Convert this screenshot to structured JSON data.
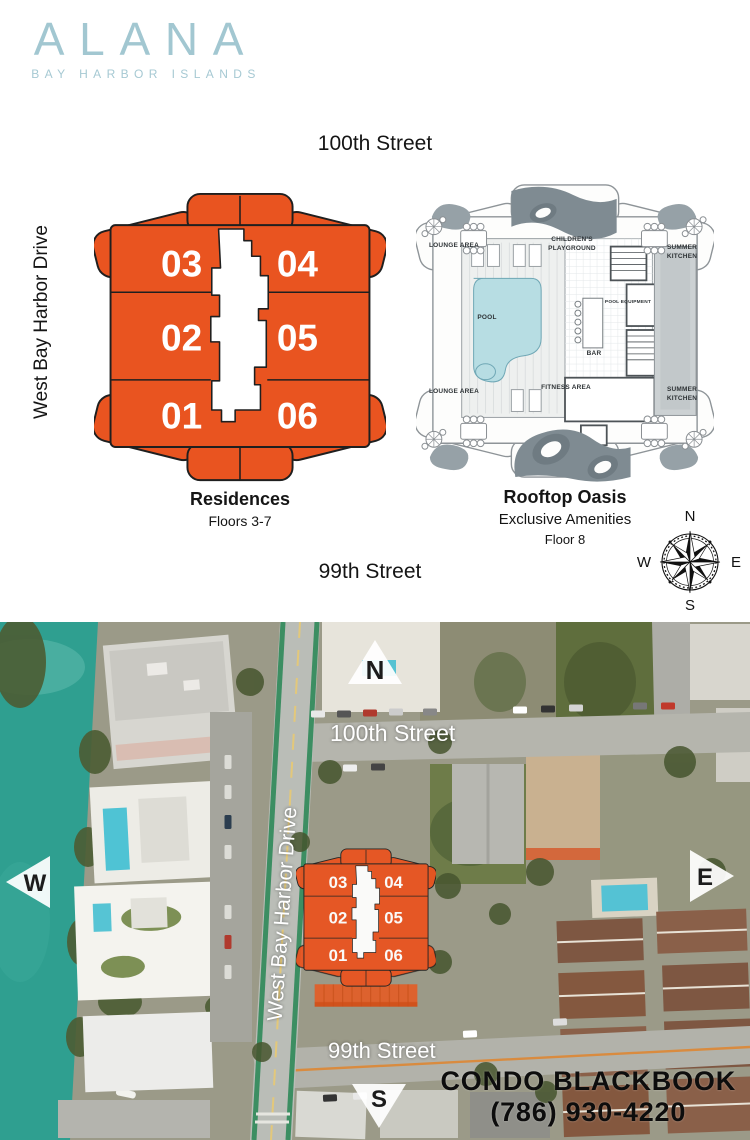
{
  "brand": {
    "name": "ALANA",
    "tagline": "BAY HARBOR ISLANDS"
  },
  "plans": {
    "street_top": "100th Street",
    "street_left": "West Bay Harbor Drive",
    "street_bottom": "99th Street",
    "residences": {
      "title": "Residences",
      "subtitle": "Floors 3-7",
      "units": [
        "01",
        "02",
        "03",
        "04",
        "05",
        "06"
      ]
    },
    "rooftop": {
      "title": "Rooftop Oasis",
      "subtitle": "Exclusive Amenities",
      "floor": "Floor 8",
      "labels": {
        "lounge_top": "LOUNGE AREA",
        "playground": "CHILDREN'S PLAYGROUND",
        "summer_top": "SUMMER KITCHEN",
        "pool": "POOL",
        "bar": "BAR",
        "pool_equipment": "POOL EQUIPMENT",
        "lounge_bottom": "LOUNGE AREA",
        "fitness": "FITNESS AREA",
        "summer_bottom": "SUMMER KITCHEN"
      }
    },
    "compass": {
      "n": "N",
      "e": "E",
      "s": "S",
      "w": "W"
    }
  },
  "map": {
    "street_100": "100th Street",
    "street_99": "99th Street",
    "street_wbhd": "West Bay Harbor Drive",
    "markers": {
      "n": "N",
      "e": "E",
      "s": "S",
      "w": "W"
    },
    "units": [
      "01",
      "02",
      "03",
      "04",
      "05",
      "06"
    ],
    "advertiser": {
      "name": "CONDO BLACKBOOK",
      "phone": "(786) 930-4220"
    }
  },
  "colors": {
    "brand_blue": "#A2C7D1",
    "plan_orange": "#E95420",
    "water_teal": "#2F9F90",
    "pool_blue": "#57C2D2"
  }
}
